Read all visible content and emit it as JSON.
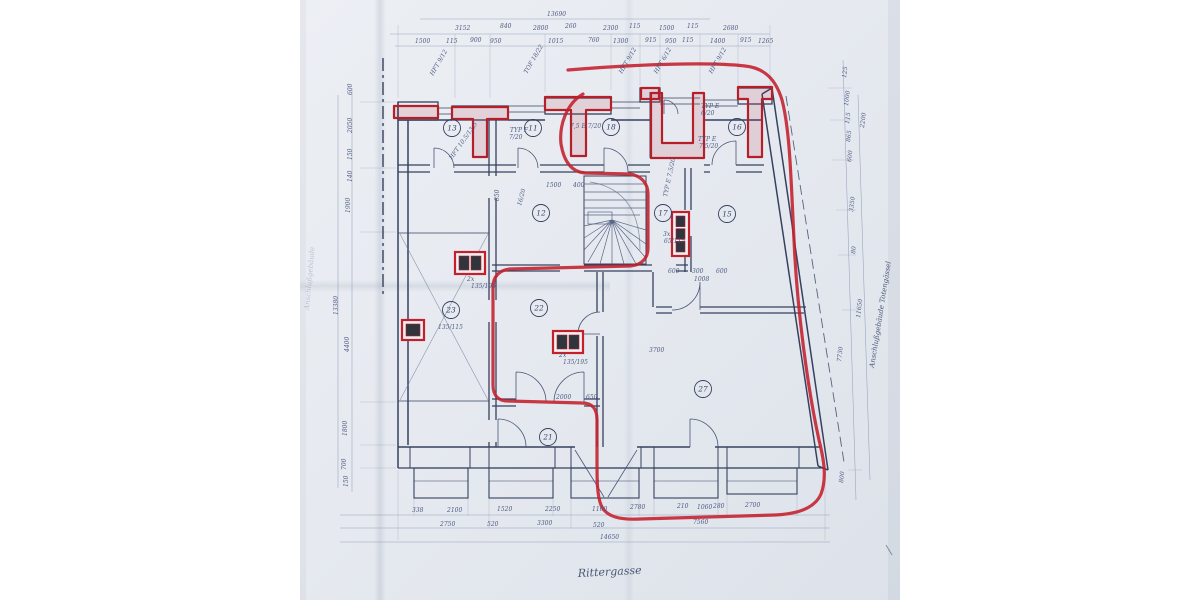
{
  "document": {
    "kind": "scanned architectural floor plan",
    "street_label": "Rittergasse",
    "left_margin_note": "Anschlußgebäude",
    "right_margin_note": "Anschlußgebäude  Totengässel"
  },
  "palette": {
    "paper": "#e7ebf1",
    "ink": "#36415f",
    "ink_light": "#8a96b2",
    "red_marker": "#c41f2b"
  },
  "rooms": [
    {
      "n": "13",
      "x": 452,
      "y": 128
    },
    {
      "n": "11",
      "x": 533,
      "y": 128
    },
    {
      "n": "18",
      "x": 611,
      "y": 127
    },
    {
      "n": "16",
      "x": 737,
      "y": 127
    },
    {
      "n": "12",
      "x": 541,
      "y": 213
    },
    {
      "n": "17",
      "x": 663,
      "y": 213
    },
    {
      "n": "15",
      "x": 727,
      "y": 214
    },
    {
      "n": "23",
      "x": 451,
      "y": 310
    },
    {
      "n": "22",
      "x": 539,
      "y": 308
    },
    {
      "n": "27",
      "x": 703,
      "y": 389
    },
    {
      "n": "21",
      "x": 548,
      "y": 437
    }
  ],
  "red_boxes": [
    {
      "x": 455,
      "y": 252,
      "w": 30,
      "h": 22,
      "cells": 2
    },
    {
      "x": 402,
      "y": 320,
      "w": 22,
      "h": 20,
      "cells": 1
    },
    {
      "x": 553,
      "y": 331,
      "w": 30,
      "h": 22,
      "cells": 2
    },
    {
      "x": 672,
      "y": 212,
      "w": 17,
      "h": 44,
      "cells": 3
    }
  ],
  "texts": [
    {
      "t": "13690",
      "x": 547,
      "y": 16
    },
    {
      "t": "3152",
      "x": 455,
      "y": 30
    },
    {
      "t": "840",
      "x": 500,
      "y": 28
    },
    {
      "t": "2800",
      "x": 533,
      "y": 30
    },
    {
      "t": "260",
      "x": 565,
      "y": 28
    },
    {
      "t": "2300",
      "x": 603,
      "y": 30
    },
    {
      "t": "115",
      "x": 629,
      "y": 28
    },
    {
      "t": "1500",
      "x": 659,
      "y": 30
    },
    {
      "t": "115",
      "x": 687,
      "y": 28
    },
    {
      "t": "2680",
      "x": 723,
      "y": 30
    },
    {
      "t": "1500",
      "x": 415,
      "y": 43
    },
    {
      "t": "115",
      "x": 446,
      "y": 43
    },
    {
      "t": "900",
      "x": 470,
      "y": 42
    },
    {
      "t": "950",
      "x": 490,
      "y": 43
    },
    {
      "t": "1015",
      "x": 548,
      "y": 43
    },
    {
      "t": "760",
      "x": 588,
      "y": 42
    },
    {
      "t": "1300",
      "x": 613,
      "y": 43
    },
    {
      "t": "915",
      "x": 645,
      "y": 42
    },
    {
      "t": "950",
      "x": 665,
      "y": 43
    },
    {
      "t": "115",
      "x": 682,
      "y": 42
    },
    {
      "t": "1400",
      "x": 710,
      "y": 43
    },
    {
      "t": "915",
      "x": 740,
      "y": 42
    },
    {
      "t": "1265",
      "x": 758,
      "y": 43
    },
    {
      "t": "338",
      "x": 412,
      "y": 512
    },
    {
      "t": "2100",
      "x": 447,
      "y": 512
    },
    {
      "t": "1520",
      "x": 497,
      "y": 511
    },
    {
      "t": "2250",
      "x": 545,
      "y": 511
    },
    {
      "t": "1160",
      "x": 592,
      "y": 511
    },
    {
      "t": "2780",
      "x": 630,
      "y": 509
    },
    {
      "t": "210",
      "x": 677,
      "y": 508
    },
    {
      "t": "1060",
      "x": 697,
      "y": 509
    },
    {
      "t": "280",
      "x": 713,
      "y": 508
    },
    {
      "t": "2700",
      "x": 745,
      "y": 507
    },
    {
      "t": "2750",
      "x": 440,
      "y": 526
    },
    {
      "t": "520",
      "x": 487,
      "y": 526
    },
    {
      "t": "3300",
      "x": 537,
      "y": 525
    },
    {
      "t": "520",
      "x": 593,
      "y": 527
    },
    {
      "t": "7560",
      "x": 693,
      "y": 524
    },
    {
      "t": "14650",
      "x": 600,
      "y": 539
    },
    {
      "t": "600",
      "x": 352,
      "y": 95,
      "r": -90
    },
    {
      "t": "2050",
      "x": 352,
      "y": 133,
      "r": -90
    },
    {
      "t": "150",
      "x": 352,
      "y": 160,
      "r": -90
    },
    {
      "t": "140",
      "x": 352,
      "y": 182,
      "r": -90
    },
    {
      "t": "1900",
      "x": 350,
      "y": 213,
      "r": -90
    },
    {
      "t": "4400",
      "x": 349,
      "y": 352,
      "r": -90
    },
    {
      "t": "1800",
      "x": 347,
      "y": 436,
      "r": -90
    },
    {
      "t": "700",
      "x": 346,
      "y": 470,
      "r": -90
    },
    {
      "t": "150",
      "x": 348,
      "y": 487,
      "r": -90
    },
    {
      "t": "13380",
      "x": 338,
      "y": 315,
      "r": -90
    },
    {
      "t": "125",
      "x": 846,
      "y": 78,
      "r": -83
    },
    {
      "t": "1000",
      "x": 848,
      "y": 106,
      "r": -83
    },
    {
      "t": "115",
      "x": 849,
      "y": 124,
      "r": -83
    },
    {
      "t": "865",
      "x": 850,
      "y": 142,
      "r": -83
    },
    {
      "t": "600",
      "x": 851,
      "y": 162,
      "r": -83
    },
    {
      "t": "3350",
      "x": 853,
      "y": 212,
      "r": -83
    },
    {
      "t": "80",
      "x": 855,
      "y": 254,
      "r": -83
    },
    {
      "t": "7730",
      "x": 841,
      "y": 362,
      "r": -83
    },
    {
      "t": "800",
      "x": 843,
      "y": 483,
      "r": -83
    },
    {
      "t": "2200",
      "x": 864,
      "y": 128,
      "r": -83
    },
    {
      "t": "11650",
      "x": 860,
      "y": 318,
      "r": -83
    },
    {
      "t": "HFT 9/12",
      "x": 433,
      "y": 76,
      "r": -60
    },
    {
      "t": "TOF 18/22",
      "x": 527,
      "y": 74,
      "r": -60
    },
    {
      "t": "HFT 9/12",
      "x": 622,
      "y": 74,
      "r": -60
    },
    {
      "t": "HFT 6/12",
      "x": 657,
      "y": 74,
      "r": -60
    },
    {
      "t": "HFT 9/12",
      "x": 712,
      "y": 74,
      "r": -60
    },
    {
      "t": "TYP F",
      "x": 510,
      "y": 132
    },
    {
      "t": "7/20",
      "x": 509,
      "y": 139
    },
    {
      "t": "7,5 E 7/20",
      "x": 570,
      "y": 128
    },
    {
      "t": "TYP E",
      "x": 701,
      "y": 108
    },
    {
      "t": "6/20",
      "x": 701,
      "y": 115
    },
    {
      "t": "TYP E",
      "x": 698,
      "y": 141
    },
    {
      "t": "7,5/20",
      "x": 699,
      "y": 148
    },
    {
      "t": "HFT 10,5/13,5",
      "x": 452,
      "y": 160,
      "r": -55
    },
    {
      "t": "16/20",
      "x": 521,
      "y": 206,
      "r": -75
    },
    {
      "t": "TYP E 7,5/20",
      "x": 667,
      "y": 197,
      "r": -78
    },
    {
      "t": "3x",
      "x": 663,
      "y": 236
    },
    {
      "t": "65/115",
      "x": 664,
      "y": 243
    },
    {
      "t": "2x",
      "x": 467,
      "y": 281
    },
    {
      "t": "135/195",
      "x": 471,
      "y": 288
    },
    {
      "t": "135/115",
      "x": 438,
      "y": 329
    },
    {
      "t": "2x",
      "x": 559,
      "y": 357
    },
    {
      "t": "135/195",
      "x": 563,
      "y": 364
    },
    {
      "t": "1500",
      "x": 546,
      "y": 187
    },
    {
      "t": "400",
      "x": 573,
      "y": 187
    },
    {
      "t": "850",
      "x": 499,
      "y": 201,
      "r": -90
    },
    {
      "t": "3700",
      "x": 649,
      "y": 352
    },
    {
      "t": "2000",
      "x": 556,
      "y": 399
    },
    {
      "t": "650",
      "x": 586,
      "y": 399
    },
    {
      "t": "600",
      "x": 668,
      "y": 273
    },
    {
      "t": "300",
      "x": 692,
      "y": 273
    },
    {
      "t": "600",
      "x": 716,
      "y": 273
    },
    {
      "t": "1008",
      "x": 694,
      "y": 281
    },
    {
      "t": "Rittergasse",
      "x": 578,
      "y": 577,
      "s": 11,
      "k": "hand",
      "r": -3
    },
    {
      "t": "Anschlußgebäude",
      "x": 309,
      "y": 310,
      "r": -85,
      "k": "handfaint"
    },
    {
      "t": "Anschlußgebäude  Totengässel",
      "x": 874,
      "y": 368,
      "r": -81,
      "k": "hand",
      "s": 7
    }
  ]
}
